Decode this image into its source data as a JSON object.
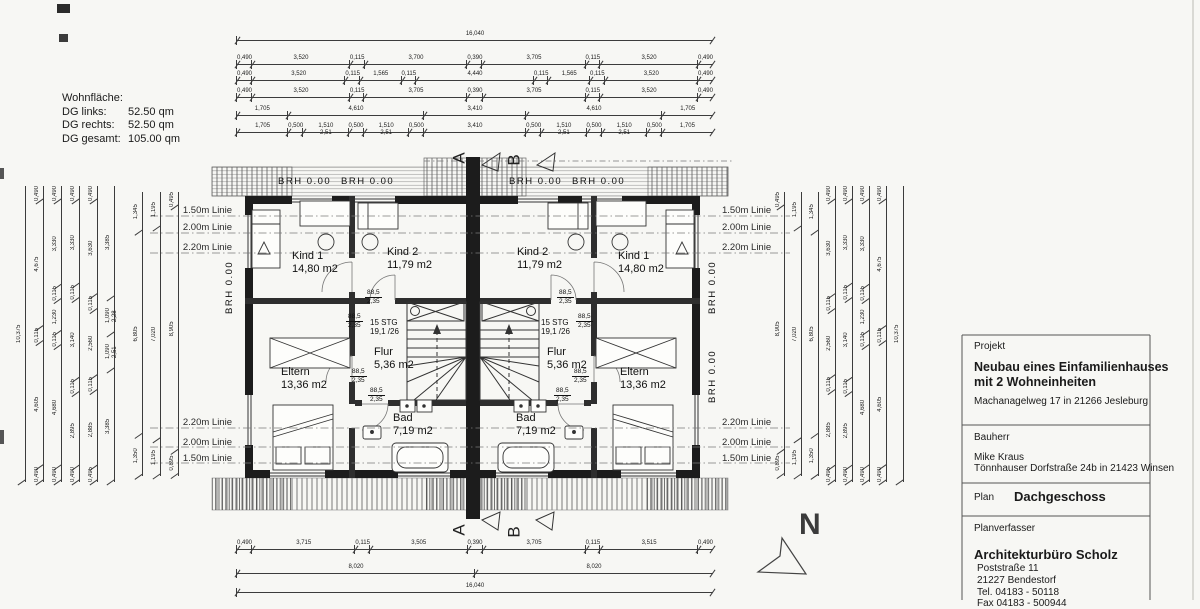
{
  "area_summary": {
    "title": "Wohnfläche:",
    "rows": [
      [
        "DG links:",
        "52.50 qm"
      ],
      [
        "DG rechts:",
        "52.50 qm"
      ],
      [
        "DG gesamt:",
        "105.00 qm"
      ]
    ]
  },
  "rooms": {
    "kind1": {
      "name": "Kind 1",
      "area": "14,80 m2"
    },
    "kind2": {
      "name": "Kind 2",
      "area": "11,79 m2"
    },
    "flur": {
      "name": "Flur",
      "area": "5,36 m2"
    },
    "bad": {
      "name": "Bad",
      "area": "7,19 m2"
    },
    "eltern": {
      "name": "Eltern",
      "area": "13,36 m2"
    },
    "stair": {
      "line1": "15 STG",
      "line2": "19,1 /26"
    }
  },
  "annotations": {
    "brh": "BRH 0.00",
    "door_w": "88,5",
    "door_h": "2,35",
    "line150": "1.50m Linie",
    "line200": "2.00m Linie",
    "line220": "2.20m Linie",
    "section_a": "A",
    "section_b": "B",
    "north": "N"
  },
  "dims": {
    "top": {
      "total": [
        "16,040"
      ],
      "r1": [
        "0,490",
        "3,520",
        "0,115",
        "3,700",
        "0,390",
        "3,705",
        "0,115",
        "3,520",
        "0,490"
      ],
      "r2": [
        "0,490",
        "3,520",
        "0,115",
        "1,565",
        "0,115",
        "4,440",
        "0,115",
        "1,565",
        "0,115",
        "3,520",
        "0,490"
      ],
      "r3": [
        "0,490",
        "3,520",
        "0,115",
        "3,705",
        "0,390",
        "3,705",
        "0,115",
        "3,520",
        "0,490"
      ],
      "r4": [
        "1,705",
        "4,610",
        "3,410",
        "4,610",
        "1,705"
      ],
      "r5": [
        "1,705",
        "0,500",
        "1,510\n2,51",
        "0,500",
        "1,510\n2,51",
        "0,500",
        "3,410",
        "0,500",
        "1,510\n2,51",
        "0,500",
        "1,510\n2,51",
        "0,500",
        "1,705"
      ]
    },
    "bottom": {
      "b1": [
        "0,490",
        "3,715",
        "0,115",
        "3,505",
        "0,390",
        "3,705",
        "0,115",
        "3,515",
        "0,490"
      ],
      "b2": [
        "8,020",
        "8,020"
      ],
      "total": [
        "16,040"
      ]
    },
    "left": {
      "c1": [
        "10,375"
      ],
      "c2": [
        "0,490",
        "4,675",
        "0,115",
        "4,605",
        "0,490"
      ],
      "c3": [
        "0,490",
        "3,330",
        "0,115",
        "1,230",
        "0,115",
        "4,680",
        "0,490"
      ],
      "c4": [
        "0,490",
        "3,330",
        "0,115",
        "3,140",
        "0,115",
        "2,895",
        "0,490"
      ],
      "c5": [
        "0,490",
        "3,630",
        "0,115",
        "2,560",
        "0,115",
        "2,885",
        "0,495"
      ],
      "c6": [
        "3,385",
        "1,090\n2,28",
        "1,090\n2,51",
        "3,385"
      ],
      "c7": [
        "1,345",
        "6,805",
        "1,350"
      ],
      "c8": [
        "1,195",
        "7,020",
        "1,195"
      ],
      "c9": [
        "0,495",
        "8,905",
        "0,895"
      ]
    },
    "right": {
      "c1": [
        "0,495",
        "8,905",
        "0,895"
      ],
      "c2": [
        "1,195",
        "7,020",
        "1,195"
      ],
      "c3": [
        "1,345",
        "6,805",
        "1,350"
      ],
      "c4": [
        "0,490",
        "3,630",
        "0,115",
        "2,560",
        "0,115",
        "2,885",
        "0,495"
      ],
      "c5": [
        "0,490",
        "3,330",
        "0,115",
        "3,140",
        "0,115",
        "2,895",
        "0,490"
      ],
      "c6": [
        "0,490",
        "3,330",
        "0,115",
        "1,230",
        "0,115",
        "4,680",
        "0,490"
      ],
      "c7": [
        "0,490",
        "4,675",
        "0,115",
        "4,605",
        "0,490"
      ],
      "c8": [
        "10,375"
      ]
    }
  },
  "titleblock": {
    "project_label": "Projekt",
    "project_title1": "Neubau eines Einfamilienhauses",
    "project_title2": "mit 2 Wohneinheiten",
    "project_address": "Machanagelweg 17 in 21266 Jesleburg",
    "client_label": "Bauherr",
    "client_name": "Mike Kraus",
    "client_address": "Tönnhauser Dorfstraße 24b in 21423 Winsen",
    "plan_label": "Plan",
    "plan_name": "Dachgeschoss",
    "author_label": "Planverfasser",
    "author_name": "Architekturbüro Scholz",
    "author_street": "Poststraße 11",
    "author_city": "21227 Bendestorf",
    "author_tel": "Tel. 04183 - 50118",
    "author_fax": "Fax 04183 - 500944"
  }
}
